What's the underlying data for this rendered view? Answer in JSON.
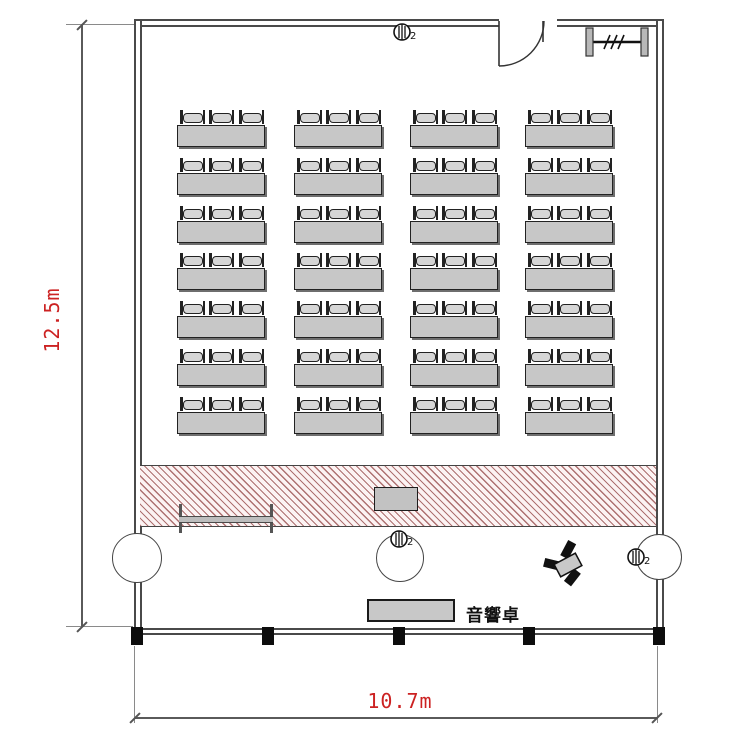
{
  "drawing": {
    "type": "room-layout-floor-plan",
    "room": {
      "height_dimension": "12.5m",
      "width_dimension": "10.7m"
    },
    "labels": {
      "sound_console": "音響卓"
    },
    "outlets": [
      {
        "name": "top-wall-outlet",
        "sub": "2"
      },
      {
        "name": "stage-front-outlet",
        "sub": "2"
      },
      {
        "name": "right-wall-outlet",
        "sub": "2"
      }
    ],
    "seating": {
      "rows": 7,
      "columns": 4,
      "chairs_per_desk": 3,
      "total_desks": 28,
      "total_chairs": 84
    },
    "colors": {
      "dimension_text": "#cc2222",
      "hatch_line": "#a05a5a",
      "desk_fill": "#c7c7c7",
      "wall": "#4a4a4a"
    }
  }
}
